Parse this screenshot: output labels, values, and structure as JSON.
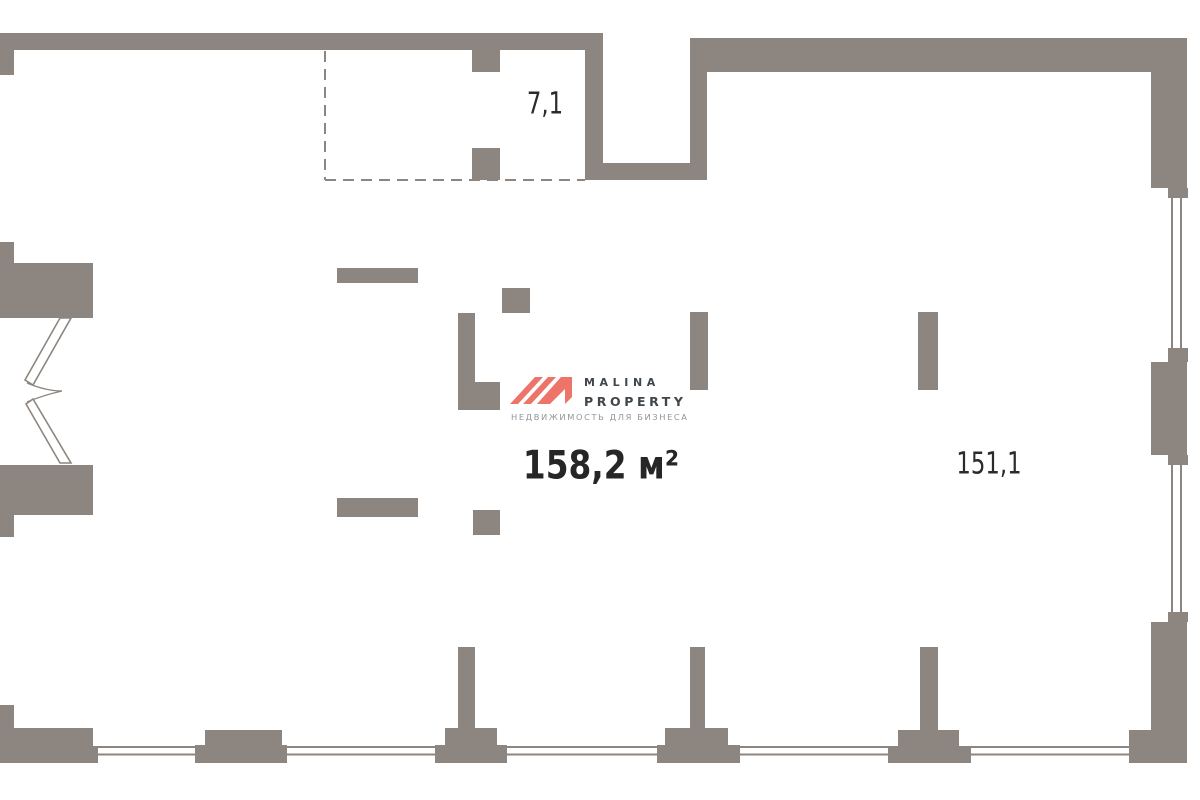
{
  "title": "Floor plan",
  "colors": {
    "background": "#ffffff",
    "wall": "#8d8680",
    "window_line": "#8d8680",
    "dash_line": "#8d8680",
    "label_text": "#2b2b2b",
    "area_text": "#262626",
    "logo_red": "#ed7468",
    "logo_text": "#3f464c",
    "logo_tagline": "#8f969d"
  },
  "areas": {
    "annex": {
      "label": "7,1"
    },
    "main": {
      "label": "158,2 м²"
    },
    "right_room": {
      "label": "151,1"
    }
  },
  "logo": {
    "brand": "MALINA",
    "brand2": "PROPERTY",
    "tagline": "НЕДВИЖИМОСТЬ ДЛЯ БИЗНЕСА"
  }
}
